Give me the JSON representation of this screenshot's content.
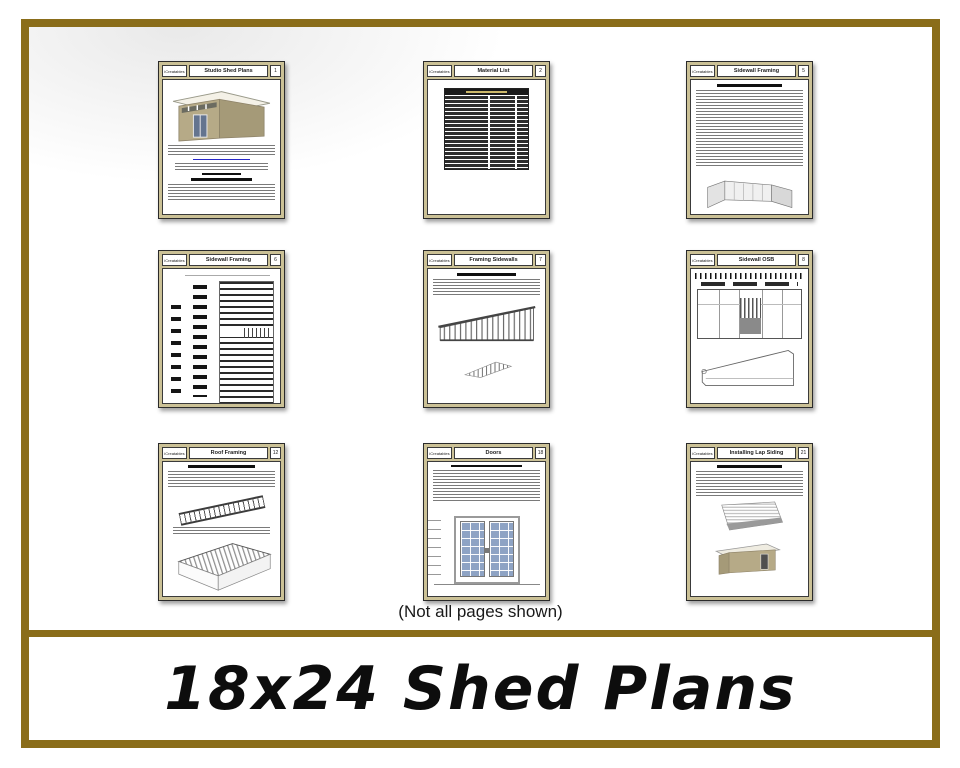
{
  "banner": {
    "title": "18x24 Shed Plans"
  },
  "note": "(Not all pages shown)",
  "colors": {
    "frame_gold": "#8a6d1a",
    "page_border_tan": "#cbc196",
    "link_blue": "#2727c8",
    "door_glass_blue": "#8ea3c4",
    "shed_siding_tan": "#b6aa87"
  },
  "pages": [
    {
      "brand": "iCreatables",
      "title": "Studio Shed Plans",
      "num": "1"
    },
    {
      "brand": "iCreatables",
      "title": "Material List",
      "num": "2"
    },
    {
      "brand": "iCreatables",
      "title": "Sidewall Framing",
      "num": "5"
    },
    {
      "brand": "iCreatables",
      "title": "Sidewall Framing",
      "num": "6"
    },
    {
      "brand": "iCreatables",
      "title": "Framing Sidewalls",
      "num": "7"
    },
    {
      "brand": "iCreatables",
      "title": "Sidewall OSB",
      "num": "8"
    },
    {
      "brand": "iCreatables",
      "title": "Roof Framing",
      "num": "12"
    },
    {
      "brand": "iCreatables",
      "title": "Doors",
      "num": "18"
    },
    {
      "brand": "iCreatables",
      "title": "Installing Lap Siding",
      "num": "21"
    }
  ]
}
